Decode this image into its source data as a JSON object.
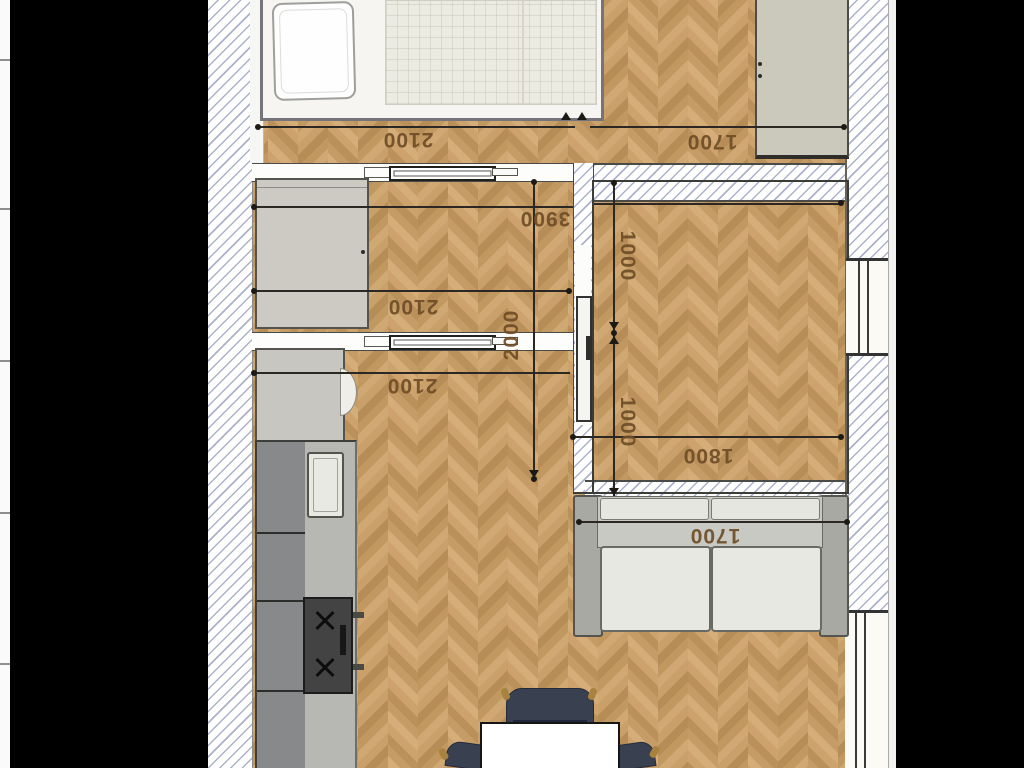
{
  "scene": {
    "kind": "apartment floor plan, top-down render, letterboxed in an image viewer",
    "flooring": "herringbone parquet",
    "orientation_note": "dimension annotations are rotated (plan shown upside-down)"
  },
  "palette": {
    "letterbox": "#000000",
    "floor": "#c69d6a",
    "floor_light": "#d4ad79",
    "floor_dark": "#b88e58",
    "hatch_line": "#989ebe",
    "wall_line": "#3b3b37",
    "dim_text": "#6e4d27",
    "dim_line": "#2b2722",
    "furniture_beige": "#cbc9bb",
    "cabinet_gray": "#88898b",
    "sofa_gray": "#e8e8e3",
    "chair_navy": "#39404f"
  },
  "dimensions": [
    {
      "id": "bedroom-width",
      "label": "2100",
      "orientation": "upside-down"
    },
    {
      "id": "top-wardrobe-width",
      "label": "1700",
      "orientation": "upside-down"
    },
    {
      "id": "middle-span",
      "label": "3900",
      "orientation": "upside-down"
    },
    {
      "id": "middle-room-width",
      "label": "2100",
      "orientation": "upside-down"
    },
    {
      "id": "living-width",
      "label": "2100",
      "orientation": "upside-down"
    },
    {
      "id": "corridor-depth",
      "label": "2000",
      "orientation": "vertical-up"
    },
    {
      "id": "room2-upper-half",
      "label": "1000",
      "orientation": "vertical-down"
    },
    {
      "id": "room2-lower-half",
      "label": "1000",
      "orientation": "vertical-down"
    },
    {
      "id": "room2-width",
      "label": "1800",
      "orientation": "upside-down"
    },
    {
      "id": "sofa-width",
      "label": "1700",
      "orientation": "upside-down"
    }
  ],
  "furniture": [
    {
      "id": "bed-with-pillow-and-duvet",
      "room": "bedroom"
    },
    {
      "id": "wardrobe",
      "room": "bedroom"
    },
    {
      "id": "wardrobe",
      "room": "middle-room"
    },
    {
      "id": "fridge",
      "room": "kitchen"
    },
    {
      "id": "cabinet-run",
      "room": "kitchen"
    },
    {
      "id": "sink",
      "room": "kitchen"
    },
    {
      "id": "stove-2-burners",
      "room": "kitchen"
    },
    {
      "id": "two-seat-sofa",
      "room": "living"
    },
    {
      "id": "dining-table",
      "room": "living"
    },
    {
      "id": "chairs",
      "count": 3,
      "room": "living"
    },
    {
      "id": "sliding-door",
      "count": 3
    },
    {
      "id": "window",
      "count": 2
    }
  ]
}
